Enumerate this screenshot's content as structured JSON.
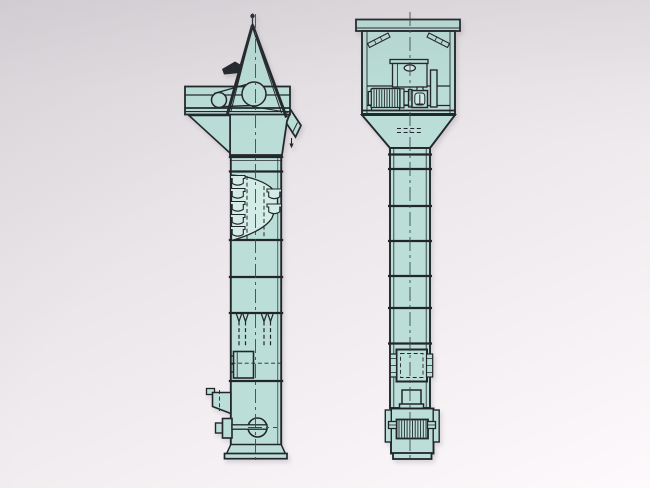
{
  "colors": {
    "bg_top": "#dedbdf",
    "bg_mid": "#eae6e9",
    "bg_bottom": "#fdf9fc",
    "fill_main": "#bbdfd8",
    "fill_light": "#d4ece6",
    "line": "#22262b",
    "line_soft": "#41474d"
  },
  "diagram": {
    "label": "bucket-elevator-two-view-technical-drawing",
    "views": [
      {
        "label": "side-elevation",
        "components": [
          "a-frame",
          "drive-platform",
          "belt-drive-pulleys",
          "motor-hood",
          "discharge-spout",
          "head-hopper",
          "casing-column",
          "flanged-joints",
          "bucket-cutaway",
          "buckets",
          "chain-strands",
          "inspection-door",
          "inlet-chute",
          "take-up-pulley",
          "base-skirt",
          "center-line"
        ]
      },
      {
        "label": "front-elevation",
        "components": [
          "top-cap",
          "head-housing",
          "corner-braces",
          "lifting-lug-panel",
          "electric-motor",
          "coupling",
          "gear-drive",
          "guard-panel",
          "service-platform",
          "transition-hopper",
          "casing-column",
          "flanged-joints",
          "inspection-window",
          "clamp-plates",
          "feed-spout",
          "boot-section",
          "boot-grate",
          "shaft-ends",
          "boot-base",
          "center-line"
        ]
      }
    ]
  }
}
